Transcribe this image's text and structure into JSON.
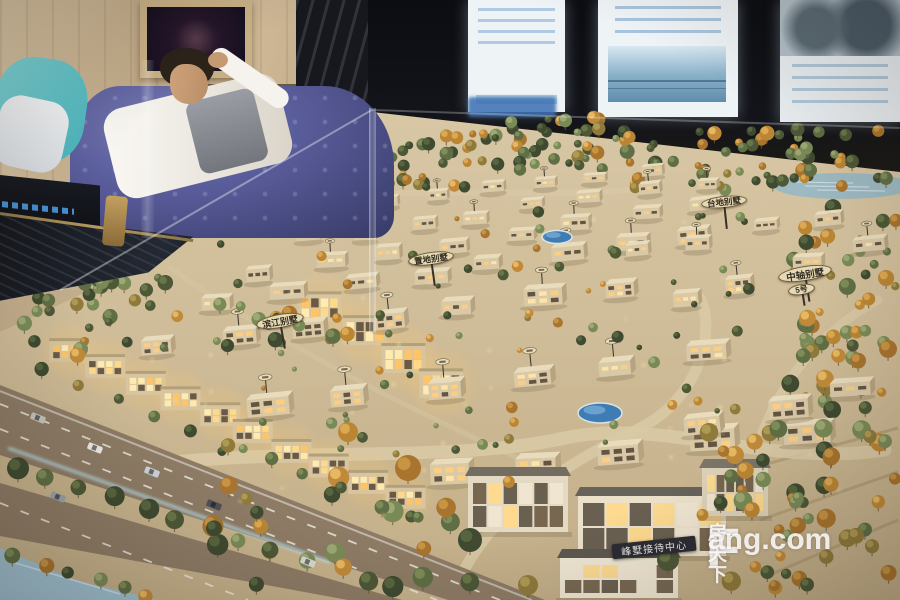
{
  "watermark": {
    "brand_f": "F",
    "brand_cn": "房天下",
    "brand_en": "ang.com"
  },
  "signs": {
    "reception": {
      "text": "峰墅接待中心"
    },
    "axis_villa": {
      "text": "中轴别墅"
    },
    "axis_villa_no": {
      "text": "5号"
    },
    "terrace_villa": {
      "text": "台地别墅"
    },
    "land_villa": {
      "text": "置地别墅"
    },
    "river_villa": {
      "text": "滨江别墅"
    }
  },
  "scene_config": {
    "ground": "372,112 620,140 900,172 900,600 0,600 0,332 160,258",
    "ground_colors": [
      "#d8c7a5",
      "#cfbc98",
      "#c2ae88"
    ],
    "water_right": {
      "cx": 843,
      "cy": 186,
      "rx": 70,
      "ry": 13
    },
    "model_paths": [
      {
        "d": "M40,482 C240,438 430,468 565,438 C660,417 770,468 885,450",
        "w": 13,
        "o": 0.85
      },
      {
        "d": "M452,598 C478,520 556,468 640,428 C700,398 716,330 700,298",
        "w": 11,
        "o": 0.8
      },
      {
        "d": "M878,300 C820,332 784,378 762,432",
        "w": 9,
        "o": 0.7
      },
      {
        "d": "M352,196 C460,188 560,198 652,188",
        "w": 6,
        "o": 0.6
      },
      {
        "d": "M170,268 C300,356 420,414 540,468",
        "w": 5,
        "o": 0.35
      }
    ],
    "road": {
      "poly": "0,385 545,600 348,600 0,536",
      "fill": "#8d7b65",
      "median": "0,455 448,600 402,600 0,483",
      "median_fill": "#c6b28c",
      "lines": [
        {
          "x1": 0,
          "y1": 404,
          "x2": 500,
          "y2": 600,
          "dash": "9 13"
        },
        {
          "x1": 0,
          "y1": 429,
          "x2": 437,
          "y2": 600,
          "dash": "9 13"
        },
        {
          "x1": 0,
          "y1": 503,
          "x2": 248,
          "y2": 600,
          "dash": "9 13"
        },
        {
          "x1": 0,
          "y1": 391,
          "x2": 532,
          "y2": 600,
          "w": 2,
          "o": 0.55
        }
      ],
      "glow": {
        "x1": 8,
        "y1": 448,
        "x2": 330,
        "y2": 562
      },
      "water_corner": "0,548 75,580 158,600 0,600"
    },
    "terraces": [
      {
        "x1": 752,
        "y1": 468,
        "x2": 898,
        "y2": 428
      },
      {
        "x1": 760,
        "y1": 520,
        "x2": 898,
        "y2": 472
      },
      {
        "x1": 772,
        "y1": 574,
        "x2": 898,
        "y2": 520
      }
    ],
    "palettes": {
      "green": [
        [
          "#4d5837",
          "#6d7b4b"
        ],
        [
          "#5f6e44",
          "#83925c"
        ],
        [
          "#7a8a57",
          "#a2ae78"
        ],
        [
          "#3f4a30",
          "#5a6a42"
        ]
      ],
      "autumn": [
        [
          "#a8742e",
          "#cc9a48"
        ],
        [
          "#bb8634",
          "#e2ae58"
        ],
        [
          "#8f7a3c",
          "#b5a058"
        ],
        [
          "#c08a3a",
          "#ecc06a"
        ]
      ]
    },
    "tree_back": [
      {
        "x": 225,
        "y": 178,
        "w": 120,
        "h": 45,
        "n": 22,
        "rmin": 3,
        "rmax": 6,
        "au": 0.3
      },
      {
        "x": 330,
        "y": 135,
        "w": 140,
        "h": 55,
        "n": 38,
        "rmin": 3.5,
        "rmax": 7,
        "au": 0.28
      },
      {
        "x": 455,
        "y": 115,
        "w": 180,
        "h": 55,
        "n": 46,
        "rmin": 3.5,
        "rmax": 7,
        "au": 0.25
      },
      {
        "x": 620,
        "y": 128,
        "w": 280,
        "h": 62,
        "n": 60,
        "rmin": 3.5,
        "rmax": 7.5,
        "au": 0.3
      },
      {
        "x": 20,
        "y": 275,
        "w": 150,
        "h": 58,
        "n": 22,
        "rmin": 4,
        "rmax": 8,
        "au": 0.1
      },
      {
        "x": 790,
        "y": 195,
        "w": 108,
        "h": 215,
        "n": 52,
        "rmin": 4,
        "rmax": 9,
        "au": 0.5
      }
    ],
    "tree_front": [
      {
        "x": 190,
        "y": 205,
        "w": 560,
        "h": 250,
        "n": 80,
        "rmin": 2.5,
        "rmax": 6,
        "au": 0.28
      },
      {
        "x": 700,
        "y": 420,
        "w": 190,
        "h": 165,
        "n": 34,
        "rmin": 5,
        "rmax": 10,
        "au": 0.45
      },
      {
        "x": 210,
        "y": 470,
        "w": 300,
        "h": 118,
        "n": 20,
        "rmin": 6,
        "rmax": 11,
        "au": 0.3
      },
      {
        "x": 30,
        "y": 300,
        "w": 320,
        "h": 60,
        "n": 24,
        "rmin": 4,
        "rmax": 8,
        "au": 0.25
      },
      {
        "x": 745,
        "y": 470,
        "w": 150,
        "h": 122,
        "n": 18,
        "rmin": 5,
        "rmax": 9,
        "au": 0.5
      }
    ],
    "tree_lines": [
      {
        "x1": 16,
        "y1": 466,
        "x2": 372,
        "y2": 580,
        "n": 12,
        "rmin": 7,
        "rmax": 11,
        "au": 0.12
      },
      {
        "x1": 15,
        "y1": 556,
        "x2": 150,
        "y2": 597,
        "n": 6,
        "rmin": 6,
        "rmax": 9,
        "au": 0.2
      },
      {
        "x1": 40,
        "y1": 372,
        "x2": 420,
        "y2": 520,
        "n": 11,
        "rmin": 5,
        "rmax": 8,
        "au": 0.3
      }
    ],
    "trees_explicit": [
      {
        "x": 408,
        "y": 468,
        "r": 13,
        "au": 1
      },
      {
        "x": 348,
        "y": 432,
        "r": 10,
        "au": 1
      },
      {
        "x": 470,
        "y": 540,
        "r": 12,
        "au": 0
      },
      {
        "x": 668,
        "y": 560,
        "r": 11,
        "au": 0
      },
      {
        "x": 528,
        "y": 585,
        "r": 10,
        "au": 1
      }
    ],
    "house_rows": [
      {
        "x": 330,
        "y": 208,
        "dx": 52,
        "dy": -7,
        "n": 7,
        "s": 0.55
      },
      {
        "x": 298,
        "y": 236,
        "dx": 57,
        "dy": -8,
        "n": 8,
        "s": 0.62
      },
      {
        "x": 252,
        "y": 266,
        "dx": 63,
        "dy": -9,
        "n": 8,
        "s": 0.72
      },
      {
        "x": 200,
        "y": 300,
        "dx": 69,
        "dy": -10,
        "n": 8,
        "s": 0.82
      },
      {
        "x": 138,
        "y": 342,
        "dx": 77,
        "dy": -10,
        "n": 7,
        "s": 0.94
      },
      {
        "x": 250,
        "y": 404,
        "dx": 86,
        "dy": -11,
        "n": 6,
        "s": 1.05
      },
      {
        "x": 425,
        "y": 468,
        "dx": 89,
        "dy": -11,
        "n": 5,
        "s": 1.12
      },
      {
        "x": 690,
        "y": 418,
        "dx": 72,
        "dy": -16,
        "n": 3,
        "s": 1.0
      },
      {
        "x": 668,
        "y": 296,
        "dx": 62,
        "dy": -18,
        "n": 4,
        "s": 0.8
      },
      {
        "x": 628,
        "y": 246,
        "dx": 64,
        "dy": -10,
        "n": 4,
        "s": 0.68
      }
    ],
    "lit_rows": [
      {
        "x": 50,
        "y": 338,
        "dx": 37,
        "dy": 16.5,
        "n": 10,
        "w": 40,
        "h": 24
      },
      {
        "x": 300,
        "y": 292,
        "dx": 40,
        "dy": 25,
        "n": 4,
        "w": 44,
        "h": 30
      }
    ],
    "pools": [
      {
        "cx": 600,
        "cy": 413,
        "rx": 22,
        "ry": 10
      },
      {
        "cx": 557,
        "cy": 237,
        "rx": 15,
        "ry": 6.5
      }
    ],
    "reception": [
      {
        "x": 468,
        "y": 476,
        "w": 100,
        "h": 56,
        "roof": "#736c60",
        "wall": "#e4dac4"
      },
      {
        "x": 578,
        "y": 496,
        "w": 148,
        "h": 60,
        "roof": "#67625a",
        "wall": "#ebe1cb"
      },
      {
        "x": 560,
        "y": 558,
        "w": 118,
        "h": 40,
        "roof": "#5d584f",
        "wall": "#efe7d4"
      },
      {
        "x": 702,
        "y": 468,
        "w": 66,
        "h": 48,
        "roof": "#7b7468",
        "wall": "#dcd1b8"
      }
    ],
    "cars": [
      {
        "x": 95,
        "y": 448,
        "c": "#eceae4"
      },
      {
        "x": 152,
        "y": 472,
        "c": "#cdd2d6"
      },
      {
        "x": 214,
        "y": 505,
        "c": "#4c5057"
      },
      {
        "x": 58,
        "y": 497,
        "c": "#9aa1a8"
      },
      {
        "x": 308,
        "y": 562,
        "c": "#d9d8d0"
      },
      {
        "x": 38,
        "y": 418,
        "c": "#c4c4bc"
      }
    ],
    "car_angle": 21.5,
    "sparkles": {
      "x": 150,
      "y": 210,
      "w": 700,
      "h": 320,
      "n": 36
    }
  }
}
